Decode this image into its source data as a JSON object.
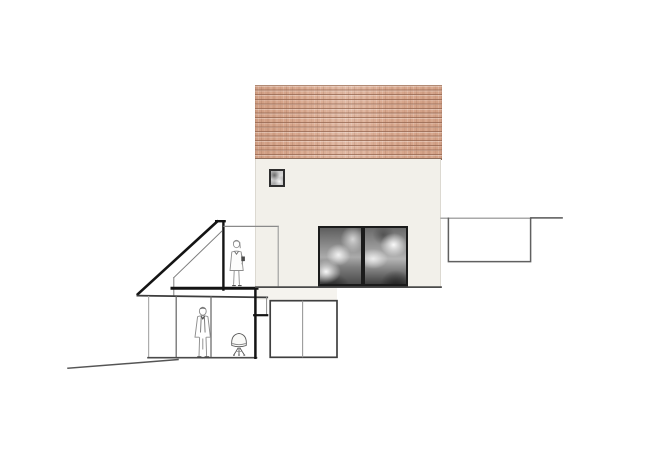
{
  "drawing": {
    "domain": "architectural section and elevation",
    "view": "side view of a gabled house; left annex and garden level shown in section; site slopes down to the left",
    "background_color": "#ffffff",
    "visible_text": "none"
  },
  "colors": {
    "background": "#ffffff",
    "roof_tile_base": "#d9a88e",
    "roof_tile_row_line": "#92634d",
    "roof_top_edge": "#b18a74",
    "roof_bottom_edge": "#8e6c59",
    "wall_fill": "#f2f0ea",
    "wall_edge": "#dcd9d1",
    "window_frame": "#1b1b1b",
    "reflection_light": "#e8e8e8",
    "reflection_dark": "#3c3c3c",
    "section_cut_line": "#141414",
    "elevation_line_dark": "#4a4a4a",
    "elevation_line_medium": "#777777",
    "elevation_line_light": "#aaaaaa",
    "ground_line": "#555555",
    "figure_line": "#8e8e8e",
    "figure_accent": "#4a4a4a",
    "outbuilding_fill": "#ffffff",
    "outbuilding_stroke": "#3f3f3f"
  },
  "main_house": {
    "tiled_roof": {
      "x": 255,
      "y": 85,
      "width": 187,
      "height": 75,
      "material": "terracotta tiles in horizontal courses"
    },
    "plaster_facade": {
      "x": 255,
      "y": 159,
      "width": 186,
      "height": 129
    },
    "attic_window": {
      "x": 269,
      "y": 169,
      "width": 16,
      "height": 18,
      "reflection": "sky"
    },
    "glass_sliding_door": {
      "x": 318,
      "y": 226,
      "width": 90,
      "height": 62,
      "panes": 2,
      "reflection": "cloudy sky"
    }
  },
  "left_annex_section": {
    "sloped_roof_cut": {
      "from": [
        217,
        221
      ],
      "to": [
        138,
        294
      ]
    },
    "apex_cut": {
      "x1": 216,
      "x2": 225,
      "y": 221
    },
    "cut_wall": {
      "x": 223,
      "y1": 221,
      "y2": 289
    },
    "roof_edge_elevation": {
      "y": 226,
      "x1": 224,
      "x2": 278
    },
    "annex_right_edge_elevation": {
      "x": 278,
      "y1": 226,
      "y2": 286
    },
    "inner_ceiling_line": {
      "from": [
        222,
        231
      ],
      "to": [
        174,
        278
      ]
    },
    "knee_wall": {
      "x": 174,
      "y1": 278,
      "y2": 296
    },
    "floor_slab_cut": {
      "y": 288,
      "x1": 172,
      "x2": 257
    },
    "facade_base_line": {
      "y": 287,
      "x1": 256,
      "x2": 441
    }
  },
  "lower_level_section": {
    "ceiling_line": {
      "x1": 138,
      "x2": 267,
      "y": 296
    },
    "left_wall": {
      "x": 149,
      "y1": 296,
      "y2": 358
    },
    "glazing_frames_x": [
      176,
      211
    ],
    "floor_line": {
      "y": 358,
      "x1": 148,
      "x2": 256
    },
    "right_wall_cut": {
      "x": 255,
      "y1": 289,
      "y2": 358
    },
    "wall_step_cut": {
      "x1": 254,
      "x2": 267,
      "y_top": 297,
      "y_bottom": 315
    }
  },
  "outbuilding_elevation": {
    "x": 270,
    "y": 301,
    "width": 67,
    "height": 57,
    "divider_x": 303
  },
  "site": {
    "ground_line_left": {
      "from": [
        68,
        368
      ],
      "to": [
        178,
        360
      ]
    },
    "ground_line_right": {
      "from": [
        441,
        218
      ],
      "to": [
        562,
        218
      ]
    },
    "sunken_lightwell": {
      "x": 448,
      "y": 218,
      "width": 82,
      "height": 43
    }
  },
  "figures": {
    "woman": {
      "location": "attic room at section cut",
      "x": 228,
      "y": 240,
      "height_px": 47,
      "detail": "standing, knee-length coat, dark handbag"
    },
    "man": {
      "location": "garden-level room",
      "x": 193,
      "y": 307,
      "height_px": 51,
      "detail": "standing, open jacket, dark hair"
    },
    "chair": {
      "location": "garden level beside room",
      "x": 230,
      "y": 333,
      "detail": "shell lounge chair on splayed legs"
    }
  }
}
